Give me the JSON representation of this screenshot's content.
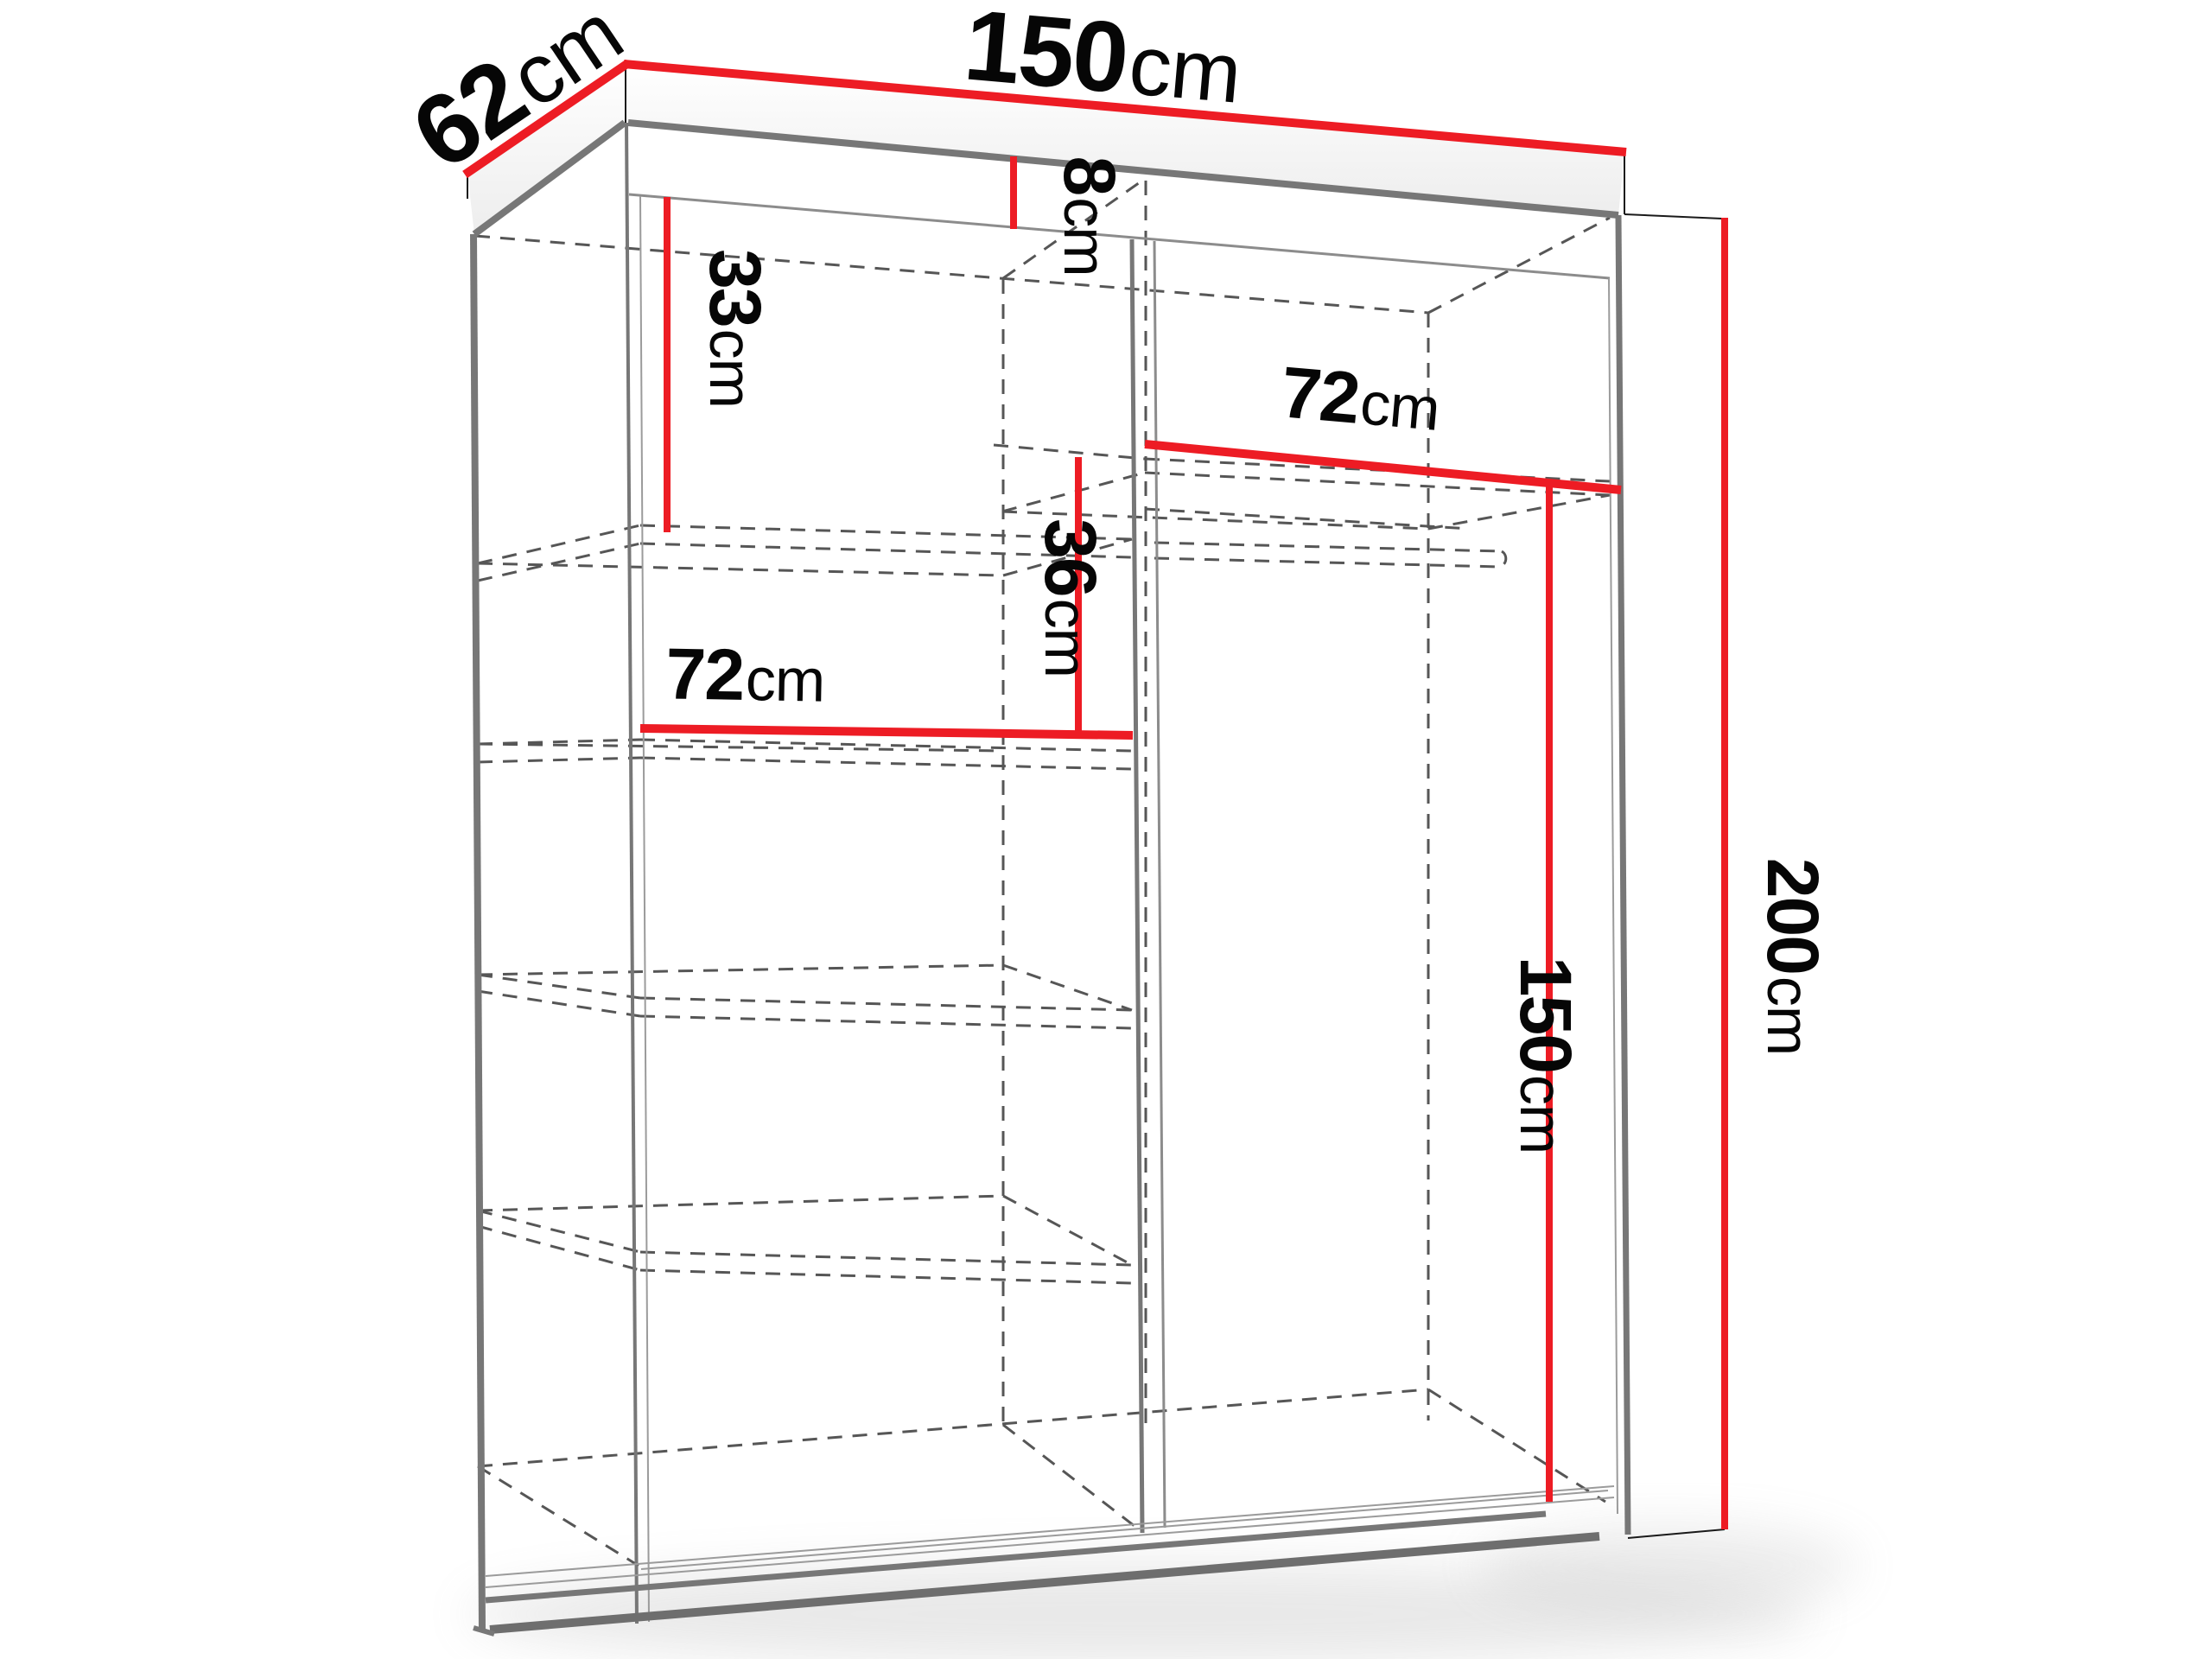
{
  "diagram": {
    "type": "wardrobe-dimension-drawing",
    "units": "cm",
    "dims": {
      "width_top": {
        "num": "150",
        "unit": "cm"
      },
      "depth": {
        "num": "62",
        "unit": "cm"
      },
      "top_panel": {
        "num": "8",
        "unit": "cm"
      },
      "top_section": {
        "num": "33",
        "unit": "cm"
      },
      "right_shelf": {
        "num": "72",
        "unit": "cm"
      },
      "shelf_gap": {
        "num": "36",
        "unit": "cm"
      },
      "left_shelf": {
        "num": "72",
        "unit": "cm"
      },
      "interior_height": {
        "num": "150",
        "unit": "cm"
      },
      "total_height": {
        "num": "200",
        "unit": "cm"
      }
    },
    "colors": {
      "dimension_red": "#ED1C24",
      "structure_gray": "#777777",
      "hidden_edge_gray": "#565656",
      "label_black": "#060606",
      "background": "#FFFFFF"
    }
  }
}
